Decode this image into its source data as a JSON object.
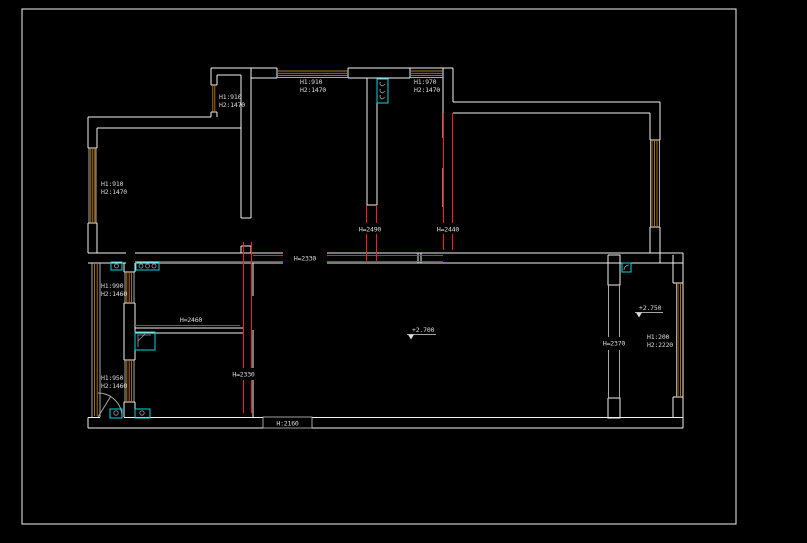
{
  "drawing": {
    "type": "cad-floor-plan",
    "background": "#000000",
    "colors": {
      "wall": "#f2f2f2",
      "wall_gray": "#a8a8a8",
      "dimension_red": "#ff1a1a",
      "window_hatch": "#b97a1e",
      "fixture_cyan": "#00d7e3",
      "text": "#dcdcdc"
    },
    "window_labels": [
      {
        "name": "small-top-room-window",
        "line1": "H1:910",
        "line2": "H2:1470"
      },
      {
        "name": "kitchen-top-window",
        "line1": "H1:910",
        "line2": "H2:1470"
      },
      {
        "name": "bath-top-window",
        "line1": "H1:970",
        "line2": "H2:1470"
      },
      {
        "name": "left-room-window",
        "line1": "H1:910",
        "line2": "H2:1470"
      },
      {
        "name": "mid-left-upper-window",
        "line1": "H1:990",
        "line2": "H2:1460"
      },
      {
        "name": "mid-left-lower-window",
        "line1": "H1:950",
        "line2": "H2:1460"
      },
      {
        "name": "balcony-window",
        "line1": "H1:200",
        "line2": "H2:2220"
      }
    ],
    "dimension_labels": [
      {
        "name": "dim-h2490",
        "text": "H=2490"
      },
      {
        "name": "dim-h2440",
        "text": "H=2440"
      },
      {
        "name": "dim-h2330-top",
        "text": "H=2330"
      },
      {
        "name": "dim-h2460",
        "text": "H=2460"
      },
      {
        "name": "dim-h2330-mid",
        "text": "H=2330"
      },
      {
        "name": "dim-h2370",
        "text": "H=2370"
      },
      {
        "name": "dim-h2160",
        "text": "H:2160"
      }
    ],
    "elevation_markers": [
      {
        "name": "living-room-level",
        "text": "+2.700"
      },
      {
        "name": "balcony-level",
        "text": "+2.750"
      }
    ]
  }
}
